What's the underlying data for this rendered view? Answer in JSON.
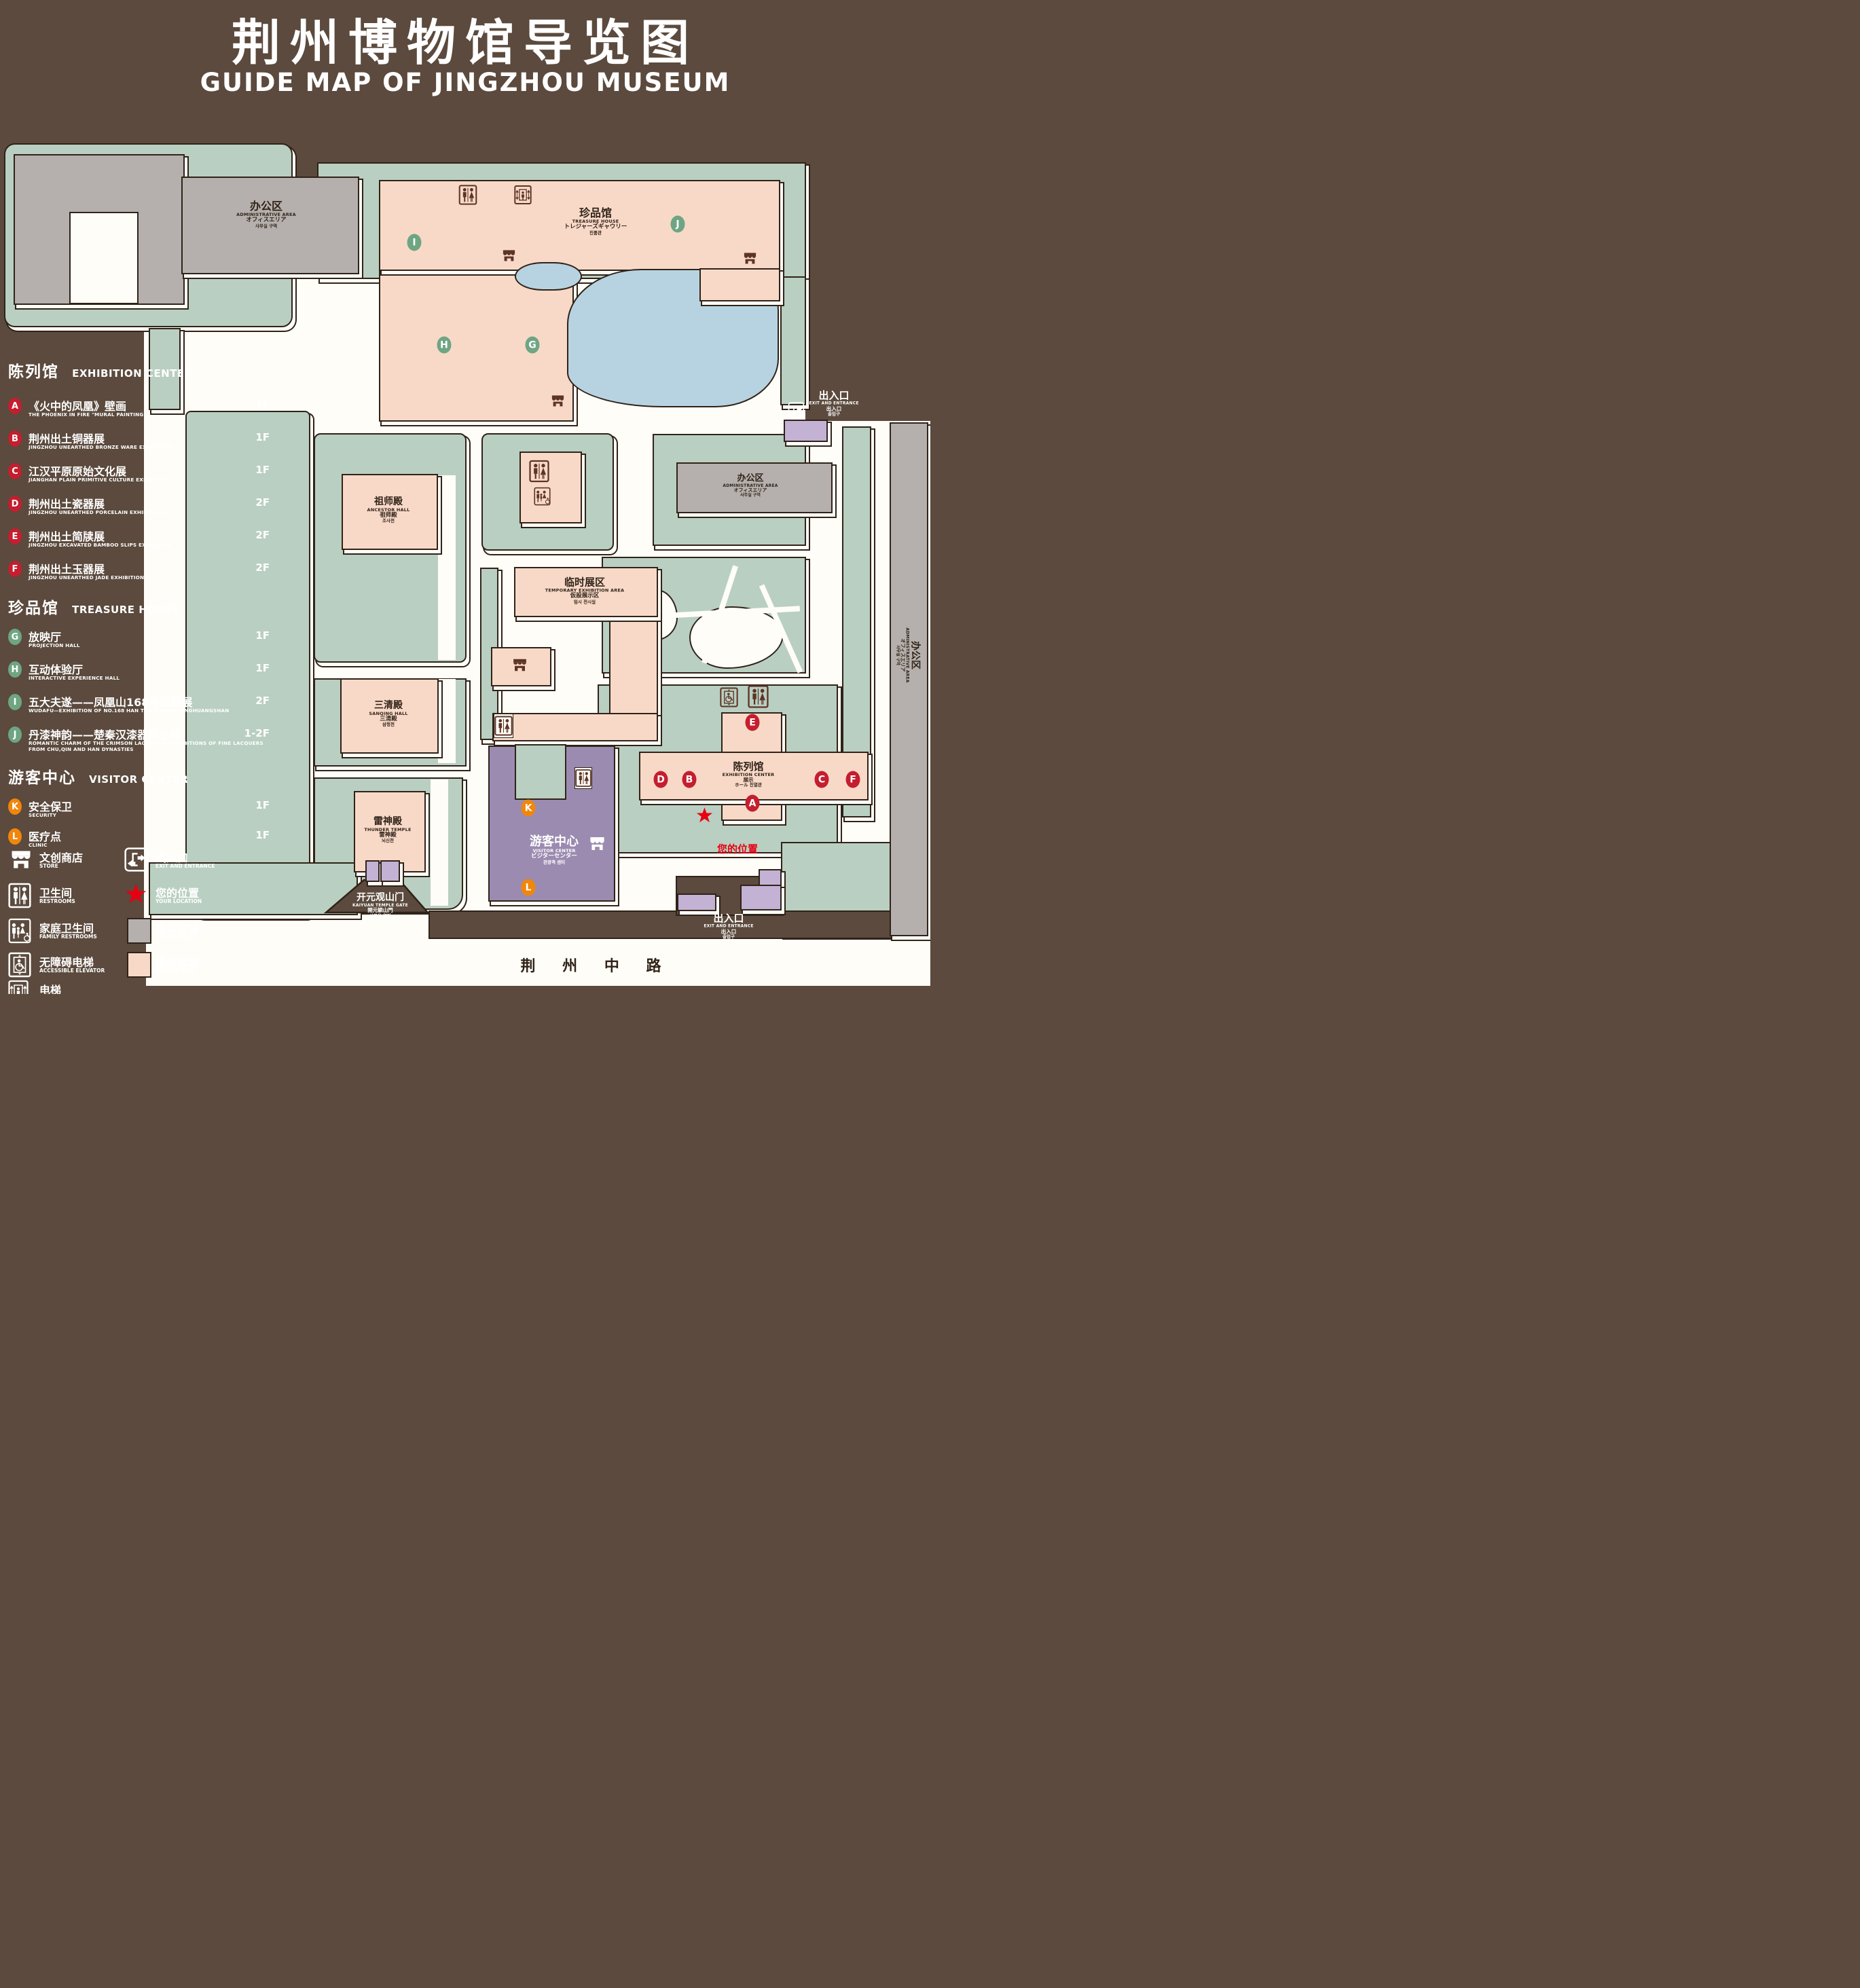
{
  "title": {
    "zh": "荆州博物馆导览图",
    "en": "GUIDE MAP OF JINGZHOU MUSEUM"
  },
  "colors": {
    "background": "#5b4a3d",
    "lawn": "#b9cfc1",
    "display_area": "#f8d9c8",
    "office_area": "#b5b0ad",
    "lake": "#b7d3e1",
    "visitor_purple": "#9b8bb0",
    "gate_purple": "#c3b2d4",
    "marker_red": "#c41e2f",
    "marker_green": "#6fa583",
    "marker_orange": "#f0860b",
    "location_red": "#e60012",
    "path_white": "#fffdf8"
  },
  "sidebar": {
    "exhibition": {
      "zh": "陈列馆",
      "en": "EXHIBITION CENTER",
      "items": [
        {
          "letter": "A",
          "zh": "《火中的凤凰》壁画",
          "en": "THE PHOENIX IN FIRE \"MURAL PAINTING",
          "floor": "1F"
        },
        {
          "letter": "B",
          "zh": "荆州出土铜器展",
          "en": "JINGZHOU UNEARTHED BRONZE WARE EXHIBITION",
          "floor": "1F"
        },
        {
          "letter": "C",
          "zh": "江汉平原原始文化展",
          "en": "JIANGHAN PLAIN PRIMITIVE CULTURE EXHIBITION",
          "floor": "1F"
        },
        {
          "letter": "D",
          "zh": "荆州出土瓷器展",
          "en": "JINGZHOU UNEARTHED PORCELAIN EXHIBITIONE",
          "floor": "2F"
        },
        {
          "letter": "E",
          "zh": "荆州出土简牍展",
          "en": "JINGZHOU EXCAVATED BAMBOO SLIPS EXHIBITION",
          "floor": "2F"
        },
        {
          "letter": "F",
          "zh": "荆州出土玉器展",
          "en": "JINGZHOU UNEARTHED JADE EXHIBITION",
          "floor": "2F"
        }
      ]
    },
    "treasure": {
      "zh": "珍品馆",
      "en": "TREASURE HOUSE",
      "items": [
        {
          "letter": "G",
          "zh": "放映厅",
          "en": "PROJECTION HALL",
          "floor": "1F"
        },
        {
          "letter": "H",
          "zh": "互动体验厅",
          "en": "INTERACTIVE EXPERIENCE HALL",
          "floor": "1F"
        },
        {
          "letter": "I",
          "zh": "五大夫遂——凤凰山168号汉墓展",
          "en": "WUDAFU—EXHIBITION OF NO.168 HAN TOMB FROM FENGHUANGSHAN",
          "floor": "2F"
        },
        {
          "letter": "J",
          "zh": "丹漆神韵——楚秦汉漆器精品展",
          "en": "ROMANTIC CHARM OF THE CRIMSON LACQUERS—EXHIBITIONS OF FINE LACQUERS FROM CHU,QIN AND HAN DYNASTIES",
          "floor": "1-2F"
        }
      ]
    },
    "visitor": {
      "zh": "游客中心",
      "en": "VISITOR CENTER",
      "items": [
        {
          "letter": "K",
          "zh": "安全保卫",
          "en": "SECURITY",
          "floor": "1F"
        },
        {
          "letter": "L",
          "zh": "医疗点",
          "en": "CLINIC",
          "floor": "1F"
        }
      ]
    },
    "legend": [
      {
        "icon": "store-icon",
        "zh": "文创商店",
        "en": "STORE"
      },
      {
        "icon": "exit-icon",
        "zh": "出入口",
        "en": "EXIT AND ENTRANCE"
      },
      {
        "icon": "restrooms-icon",
        "zh": "卫生间",
        "en": "RESTROOMS"
      },
      {
        "icon": "location-star-icon",
        "zh": "您的位置",
        "en": "YOUR LOCATION"
      },
      {
        "icon": "family-restrooms-icon",
        "zh": "家庭卫生间",
        "en": "FAMILY RESTROOMS"
      },
      {
        "icon": "office-area-swatch",
        "zh": "办公区域",
        "en": "OFFICE AREA"
      },
      {
        "icon": "accessible-elevator-icon",
        "zh": "无障碍电梯",
        "en": "ACCESSIBLE ELEVATOR"
      },
      {
        "icon": "display-area-swatch",
        "zh": "展示区域",
        "en": "DISPLAY AREA"
      },
      {
        "icon": "elevator-icon",
        "zh": "电梯",
        "en": "Elevator"
      }
    ]
  },
  "map": {
    "admin_area": {
      "lines": [
        "办公区",
        "ADMINISTRATIVE AREA",
        "オフィスエリア",
        "사무실 구역"
      ]
    },
    "treasure_house": {
      "lines": [
        "珍品馆",
        "TREASURE HOUSE",
        "トレジャーズギャウリー",
        "진품관"
      ]
    },
    "ancestor_hall": {
      "lines": [
        "祖师殿",
        "ANCESTOR HALL",
        "祖师殿",
        "조사전"
      ]
    },
    "sanqing_hall": {
      "lines": [
        "三清殿",
        "SANQING HALL",
        "三清殿",
        "삼청전"
      ]
    },
    "thunder_temple": {
      "lines": [
        "雷神殿",
        "THUNDER TEMPLE",
        "雷神殿",
        "뇌신전"
      ]
    },
    "temporary_area": {
      "lines": [
        "临时展区",
        "TEMPORARY EXHIBITION AREA",
        "仮設展示区",
        "임시 전시실"
      ]
    },
    "visitor_center": {
      "lines": [
        "游客中心",
        "VISITOR CENTER",
        "ビジターセンター",
        "관광객 센터"
      ]
    },
    "exhibition_center": {
      "lines": [
        "陈列馆",
        "EXHIBITION CENTER",
        "展示",
        "ホール 진열관"
      ]
    },
    "gate": {
      "lines": [
        "开元观山门",
        "KAIYUAN TEMPLE GATE",
        "開元観山門",
        "산문을 열다"
      ]
    },
    "exit": {
      "lines": [
        "出入口",
        "EXIT AND ENTRANCE",
        "出入口",
        "출입구"
      ]
    },
    "your_location": "您的位置",
    "road": "荆 州 中 路",
    "markers": [
      {
        "letter": "A"
      },
      {
        "letter": "B"
      },
      {
        "letter": "C"
      },
      {
        "letter": "D"
      },
      {
        "letter": "E"
      },
      {
        "letter": "F"
      },
      {
        "letter": "G"
      },
      {
        "letter": "H"
      },
      {
        "letter": "I"
      },
      {
        "letter": "J"
      },
      {
        "letter": "K"
      },
      {
        "letter": "L"
      }
    ]
  }
}
